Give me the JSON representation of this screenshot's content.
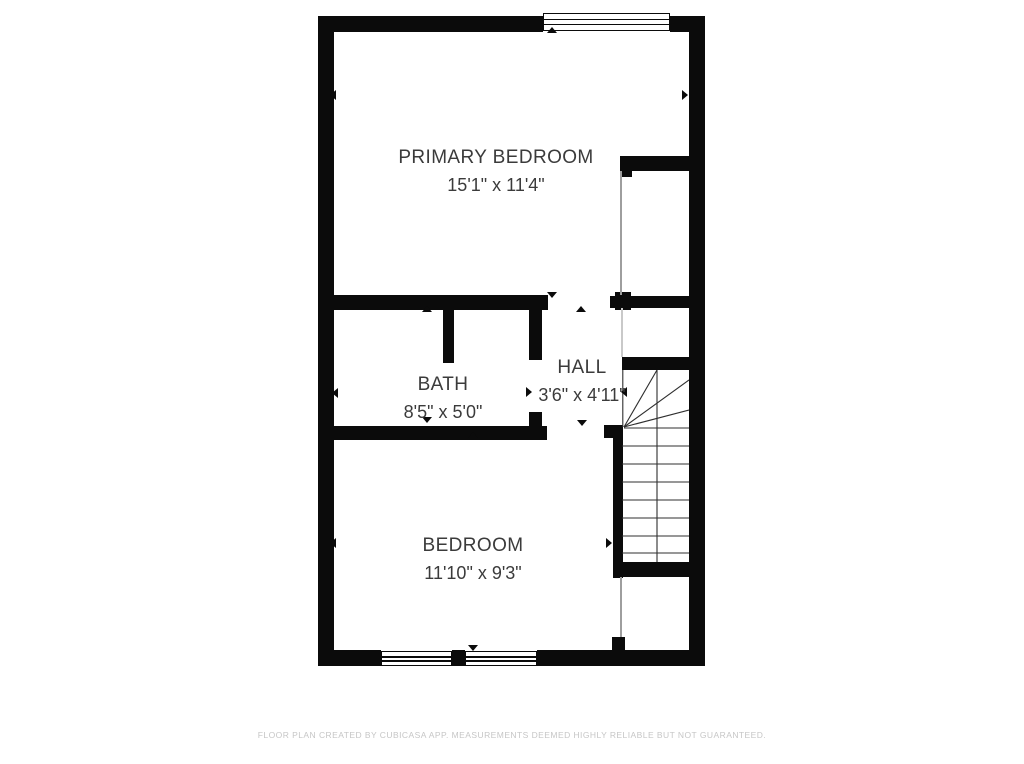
{
  "plan": {
    "rooms": [
      {
        "name": "PRIMARY BEDROOM",
        "dimensions": "15'1\" x 11'4\""
      },
      {
        "name": "BATH",
        "dimensions": "8'5\" x 5'0\""
      },
      {
        "name": "HALL",
        "dimensions": "3'6\" x 4'11\""
      },
      {
        "name": "BEDROOM",
        "dimensions": "11'10\" x 9'3\""
      }
    ],
    "symbols": {
      "windows": 3,
      "stairs": "winder-staircase",
      "dimension_marker": "triangle-tick"
    },
    "colors": {
      "wall": "#0b0b0b",
      "room_text": "#3b3b3b",
      "stair_line": "#2f2f2f",
      "footer_text": "#c6c6c6",
      "background": "#ffffff"
    }
  },
  "footer": {
    "disclaimer": "FLOOR PLAN CREATED BY CUBICASA APP. MEASUREMENTS DEEMED HIGHLY RELIABLE BUT NOT GUARANTEED."
  }
}
